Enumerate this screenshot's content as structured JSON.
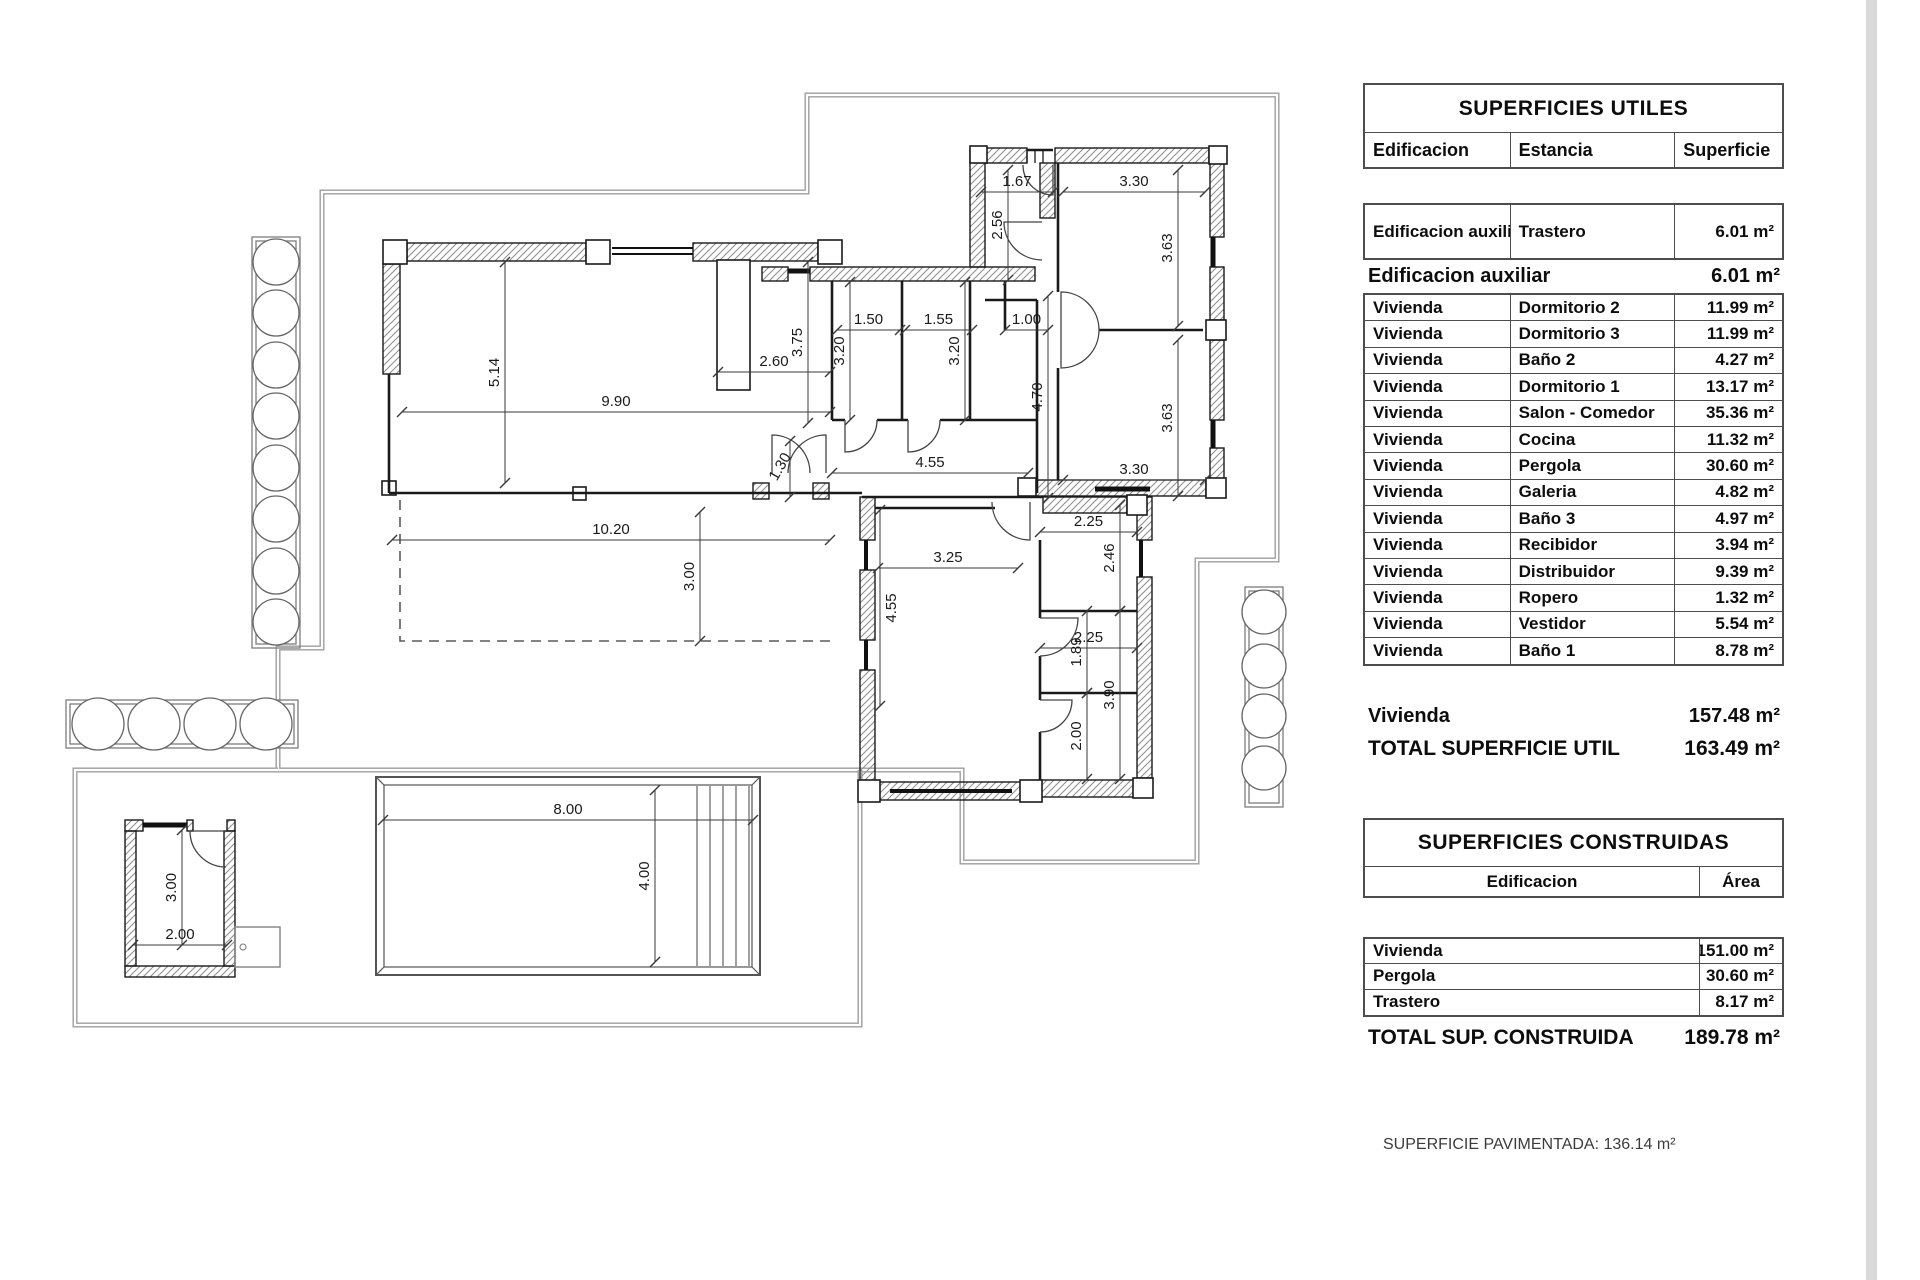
{
  "tables": {
    "utiles": {
      "title": "SUPERFICIES UTILES",
      "col_headers": [
        "Edificacion",
        "Estancia",
        "Superficie"
      ],
      "aux_rows": [
        {
          "building": "Edificacion auxiliar",
          "room": "Trastero",
          "area": "6.01 m²"
        }
      ],
      "aux_subtotal": {
        "label": "Edificacion auxiliar",
        "value": "6.01 m²"
      },
      "rows": [
        {
          "building": "Vivienda",
          "room": "Dormitorio 2",
          "area": "11.99 m²"
        },
        {
          "building": "Vivienda",
          "room": "Dormitorio 3",
          "area": "11.99 m²"
        },
        {
          "building": "Vivienda",
          "room": "Baño 2",
          "area": "4.27 m²"
        },
        {
          "building": "Vivienda",
          "room": "Dormitorio 1",
          "area": "13.17 m²"
        },
        {
          "building": "Vivienda",
          "room": "Salon - Comedor",
          "area": "35.36 m²"
        },
        {
          "building": "Vivienda",
          "room": "Cocina",
          "area": "11.32 m²"
        },
        {
          "building": "Vivienda",
          "room": "Pergola",
          "area": "30.60 m²"
        },
        {
          "building": "Vivienda",
          "room": "Galeria",
          "area": "4.82 m²"
        },
        {
          "building": "Vivienda",
          "room": "Baño 3",
          "area": "4.97 m²"
        },
        {
          "building": "Vivienda",
          "room": "Recibidor",
          "area": "3.94 m²"
        },
        {
          "building": "Vivienda",
          "room": "Distribuidor",
          "area": "9.39 m²"
        },
        {
          "building": "Vivienda",
          "room": "Ropero",
          "area": "1.32 m²"
        },
        {
          "building": "Vivienda",
          "room": "Vestidor",
          "area": "5.54 m²"
        },
        {
          "building": "Vivienda",
          "room": "Baño 1",
          "area": "8.78 m²"
        }
      ],
      "vivienda_subtotal": {
        "label": "Vivienda",
        "value": "157.48 m²"
      },
      "total": {
        "label": "TOTAL SUPERFICIE UTIL",
        "value": "163.49 m²"
      }
    },
    "construidas": {
      "title": "SUPERFICIES CONSTRUIDAS",
      "col_headers": [
        "Edificacion",
        "Área"
      ],
      "rows": [
        {
          "building": "Vivienda",
          "area": "151.00 m²"
        },
        {
          "building": "Pergola",
          "area": "30.60 m²"
        },
        {
          "building": "Trastero",
          "area": "8.17 m²"
        }
      ],
      "total": {
        "label": "TOTAL SUP. CONSTRUIDA",
        "value": "189.78 m²"
      }
    }
  },
  "footer_note": "SUPERFICIE PAVIMENTADA: 136.14 m²",
  "plan": {
    "dimensions": [
      {
        "t": "5.14",
        "x1": 505,
        "y1": 262,
        "x2": 505,
        "y2": 483
      },
      {
        "t": "9.90",
        "x1": 402,
        "y1": 412,
        "x2": 830,
        "y2": 412
      },
      {
        "t": "2.60",
        "x1": 718,
        "y1": 372,
        "x2": 830,
        "y2": 372
      },
      {
        "t": "3.75",
        "x1": 808,
        "y1": 262,
        "x2": 808,
        "y2": 423
      },
      {
        "t": "1.50",
        "x1": 837,
        "y1": 330,
        "x2": 900,
        "y2": 330
      },
      {
        "t": "3.20",
        "x1": 850,
        "y1": 282,
        "x2": 850,
        "y2": 420
      },
      {
        "t": "1.55",
        "x1": 905,
        "y1": 330,
        "x2": 972,
        "y2": 330
      },
      {
        "t": "3.20",
        "x1": 965,
        "y1": 282,
        "x2": 965,
        "y2": 420
      },
      {
        "t": "1.00",
        "x1": 1005,
        "y1": 330,
        "x2": 1048,
        "y2": 330
      },
      {
        "t": "4.70",
        "x1": 1048,
        "y1": 296,
        "x2": 1048,
        "y2": 498
      },
      {
        "t": "1.67",
        "x1": 981,
        "y1": 192,
        "x2": 1053,
        "y2": 192
      },
      {
        "t": "2.56",
        "x1": 1008,
        "y1": 170,
        "x2": 1008,
        "y2": 280
      },
      {
        "t": "3.30",
        "x1": 1063,
        "y1": 192,
        "x2": 1205,
        "y2": 192
      },
      {
        "t": "3.63",
        "x1": 1178,
        "y1": 170,
        "x2": 1178,
        "y2": 326
      },
      {
        "t": "3.63",
        "x1": 1178,
        "y1": 340,
        "x2": 1178,
        "y2": 496
      },
      {
        "t": "3.30",
        "x1": 1063,
        "y1": 480,
        "x2": 1205,
        "y2": 480
      },
      {
        "t": "1.30",
        "x1": 790,
        "y1": 441,
        "x2": 790,
        "y2": 497,
        "lr": -60
      },
      {
        "t": "4.55",
        "x1": 832,
        "y1": 473,
        "x2": 1028,
        "y2": 473
      },
      {
        "t": "10.20",
        "x1": 392,
        "y1": 540,
        "x2": 830,
        "y2": 540
      },
      {
        "t": "3.00",
        "x1": 700,
        "y1": 512,
        "x2": 700,
        "y2": 641
      },
      {
        "t": "4.55",
        "x1": 880,
        "y1": 510,
        "x2": 880,
        "y2": 706,
        "ls": 1
      },
      {
        "t": "3.25",
        "x1": 878,
        "y1": 568,
        "x2": 1018,
        "y2": 568
      },
      {
        "t": "2.25",
        "x1": 1040,
        "y1": 532,
        "x2": 1137,
        "y2": 532
      },
      {
        "t": "2.46",
        "x1": 1120,
        "y1": 505,
        "x2": 1120,
        "y2": 611
      },
      {
        "t": "2.25",
        "x1": 1040,
        "y1": 648,
        "x2": 1137,
        "y2": 648
      },
      {
        "t": "1.89",
        "x1": 1087,
        "y1": 611,
        "x2": 1087,
        "y2": 693
      },
      {
        "t": "3.90",
        "x1": 1120,
        "y1": 611,
        "x2": 1120,
        "y2": 779
      },
      {
        "t": "2.00",
        "x1": 1087,
        "y1": 693,
        "x2": 1087,
        "y2": 779
      },
      {
        "t": "8.00",
        "x1": 383,
        "y1": 820,
        "x2": 753,
        "y2": 820
      },
      {
        "t": "4.00",
        "x1": 655,
        "y1": 790,
        "x2": 655,
        "y2": 962
      },
      {
        "t": "3.00",
        "x1": 182,
        "y1": 830,
        "x2": 182,
        "y2": 945
      },
      {
        "t": "2.00",
        "x1": 133,
        "y1": 945,
        "x2": 227,
        "y2": 945
      }
    ]
  }
}
